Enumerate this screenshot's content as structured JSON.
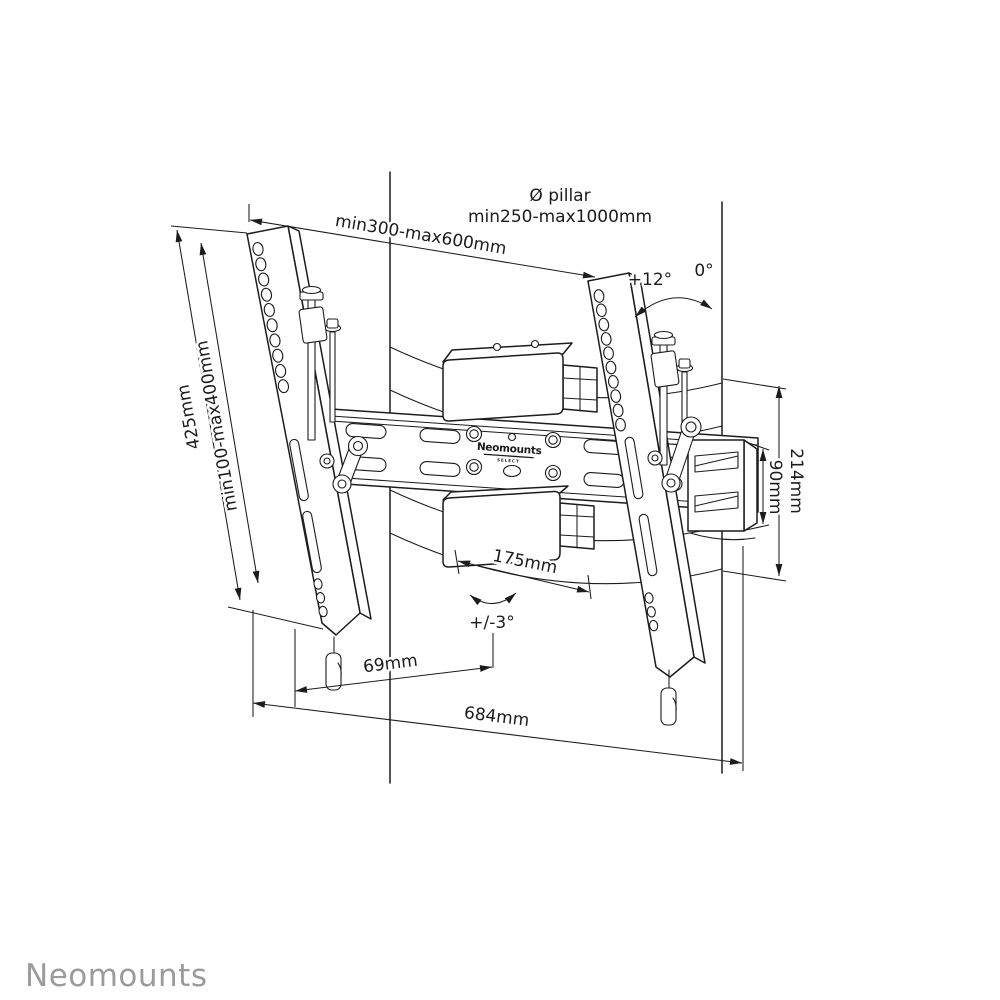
{
  "pillar_label": {
    "line1": "Ø pillar",
    "line2": "min250-max1000mm"
  },
  "dims": {
    "top_width": "min300-max600mm",
    "left_outer": "425mm",
    "left_inner": "min100-max400mm",
    "tilt_up": "+12°",
    "tilt_zero": "0°",
    "right_outer": "214mm",
    "right_inner": "90mm",
    "clamp_width": "175mm",
    "swivel": "+/-3°",
    "bottom_inner": "69mm",
    "bottom_outer": "684mm"
  },
  "plate_logo": {
    "name": "Neomounts",
    "sub": "SELECT"
  },
  "brand": {
    "name": "Neomounts"
  },
  "colors": {
    "line": "#1c1c1c",
    "brand_gray": "#9b9b9b",
    "background": "#ffffff"
  }
}
